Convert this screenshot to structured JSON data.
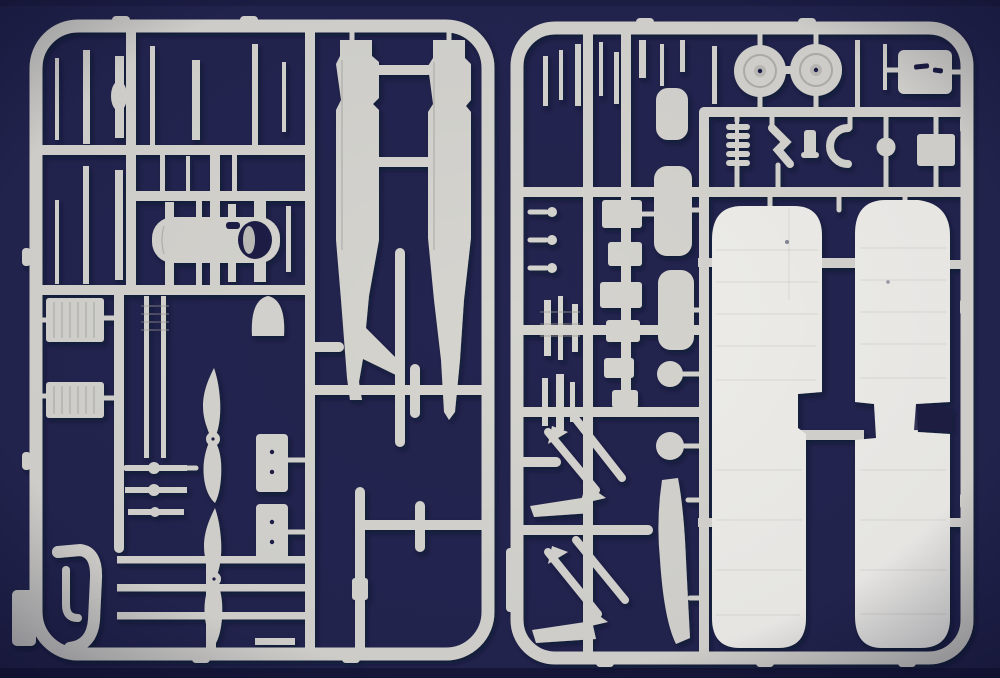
{
  "image": {
    "type": "photograph",
    "subject": "Two light-grey injection-molded plastic model kit sprues of a biplane aircraft kit photographed on a dark navy blue background",
    "orientation": "landscape",
    "text_visible": "none"
  },
  "colors": {
    "background": "#23244f",
    "background_edge": "#0c0d28",
    "plastic": "#d5d4cf",
    "plastic_bright": "#efeeea",
    "plastic_dim": "#bdbcb7",
    "plastic_shadow": "#97968f",
    "detail_dark": "#1c1d44"
  },
  "sprues": [
    {
      "id": "left-sprue",
      "position": "left half of photo",
      "parts": [
        "small airframe struts (two rows)",
        "fuselage half x2 with tail fin",
        "engine cowling with open front",
        "bell-shaped fairing",
        "finned radiator core x2",
        "thin gun-barrel rods with ball joints",
        "two-blade propeller x2",
        "hatch panel with rivet holes x2",
        "spar bars x3",
        "curved exhaust manifold",
        "sprue gate tab"
      ]
    },
    {
      "id": "right-sprue",
      "position": "right half of photo",
      "parts": [
        "small struts row",
        "main wheel x2 with hub",
        "engine mount plate with markings",
        "cylinder with cooling fins",
        "angled bracket",
        "crescent part",
        "small ball part x3",
        "equipment boxes",
        "interplane strut panel x3",
        "round ball part x2",
        "curved skid blade",
        "landing-gear V-strut pair x2",
        "arrow-shaped strut foot x2",
        "upper wing panel",
        "lower wing panel"
      ]
    }
  ]
}
